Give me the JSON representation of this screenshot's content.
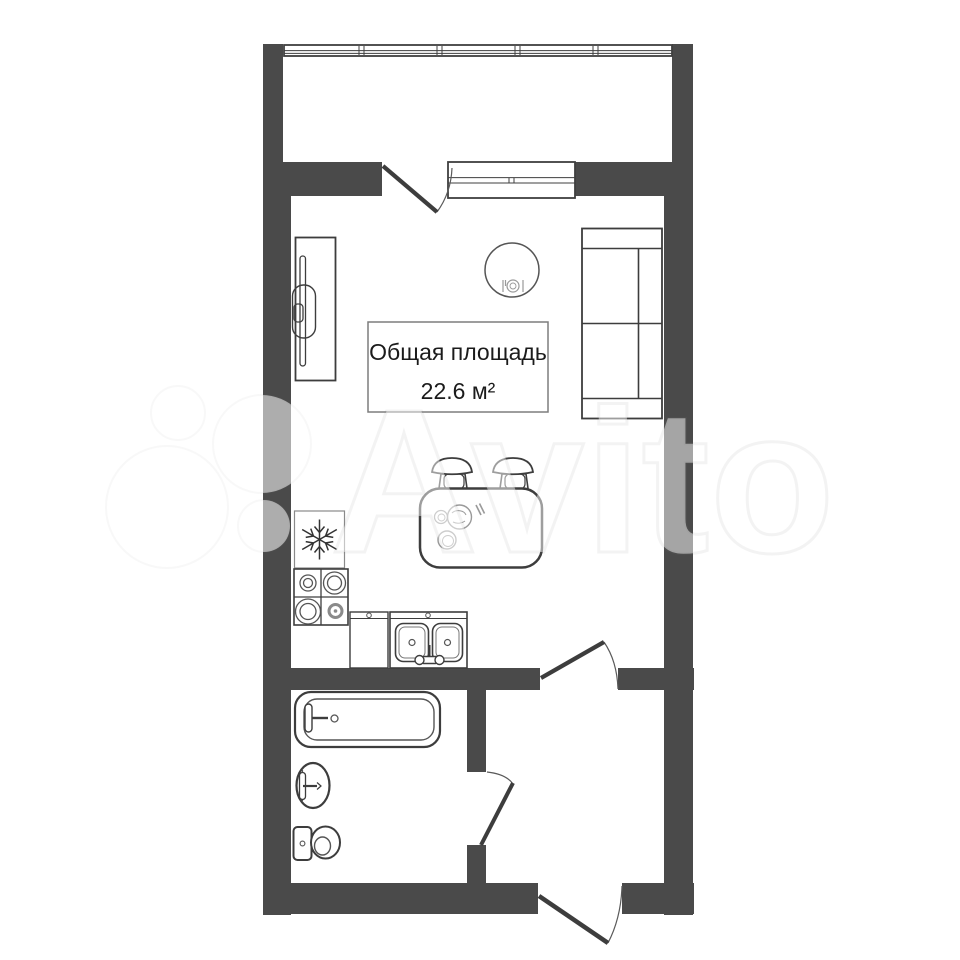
{
  "watermark": {
    "text": "Avito"
  },
  "floor_plan": {
    "area_label": {
      "title": "Общая площадь",
      "value": "22.6 м²"
    },
    "colors": {
      "wall": "#4a4a4a",
      "outline": "#3d3d3d",
      "light_outline": "#999999",
      "background": "#ffffff",
      "label_border": "#7d7d7d"
    },
    "symbols": {
      "fridge": "snowflake-icon",
      "round_table": "place-setting-icon",
      "stove": "four-burner-hob",
      "sink": "double-bowl-sink",
      "bath": "bathtub",
      "basin": "washbasin",
      "wc": "toilet",
      "sofa": "two-seat-sofa",
      "wardrobe": "wardrobe-with-rail",
      "dining": "table-with-two-chairs",
      "doors": [
        "balcony-door",
        "room-door",
        "bathroom-door",
        "entrance-door"
      ],
      "windows": [
        "balcony-glazing",
        "room-window"
      ]
    }
  }
}
